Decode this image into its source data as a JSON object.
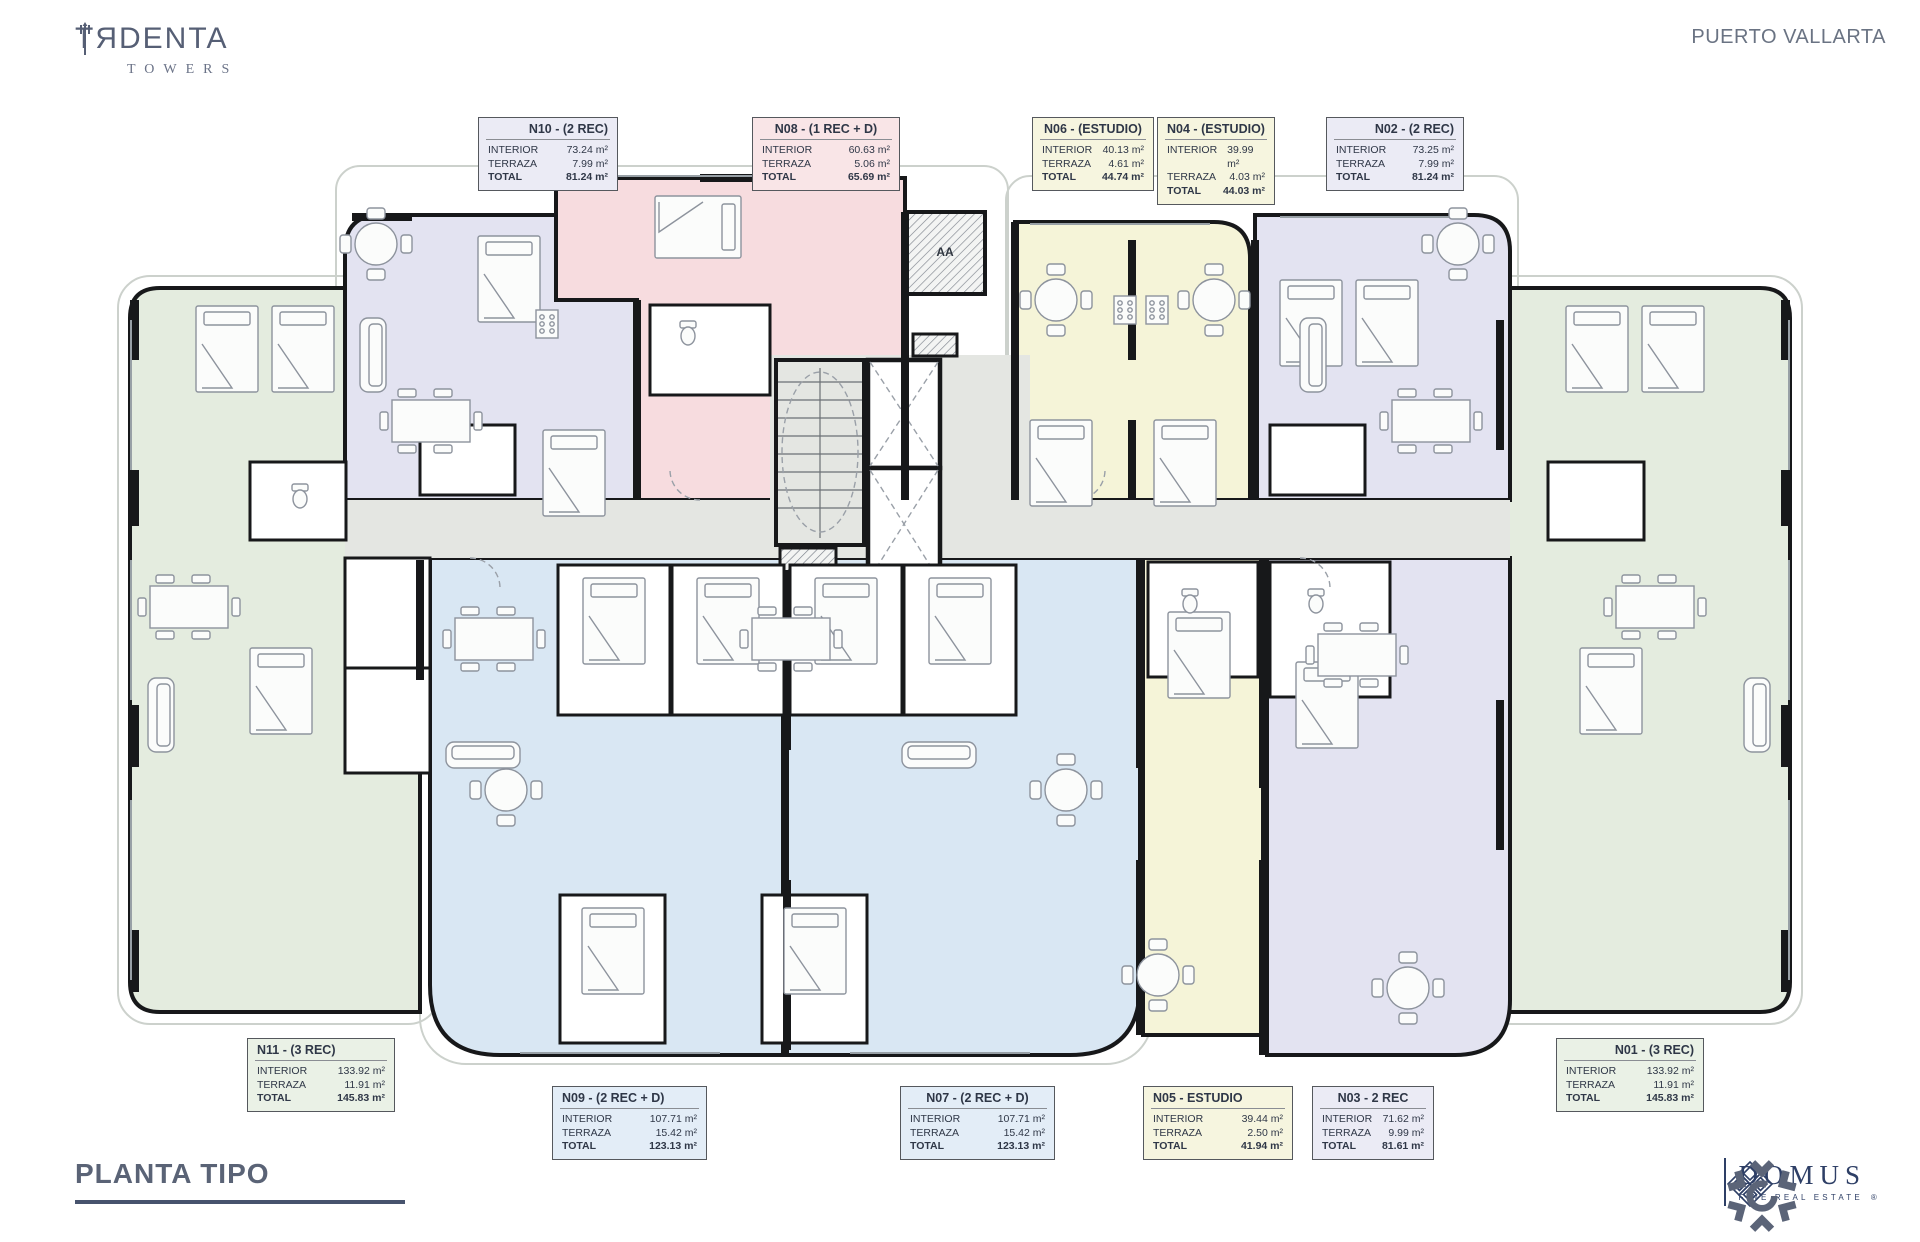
{
  "header": {
    "brand_part1": "TЯ",
    "brand_part2": "DENTA",
    "brand_sub": "TOWERS",
    "location": "PUERTO VALLARTA"
  },
  "labels": {
    "interior": "INTERIOR",
    "terraza": "TERRAZA",
    "total": "TOTAL"
  },
  "units": [
    {
      "id": "N10",
      "title": "N10 - (2 REC)",
      "interior": "73.24 m²",
      "terraza": "7.99 m²",
      "total": "81.24 m²",
      "tint": "#ebebf5"
    },
    {
      "id": "N08",
      "title": "N08 - (1 REC + D)",
      "interior": "60.63 m²",
      "terraza": "5.06 m²",
      "total": "65.69 m²",
      "tint": "#f9e5e7"
    },
    {
      "id": "N06",
      "title": "N06 - (ESTUDIO)",
      "interior": "40.13 m²",
      "terraza": "4.61 m²",
      "total": "44.74 m²",
      "tint": "#f6f5df"
    },
    {
      "id": "N04",
      "title": "N04 - (ESTUDIO)",
      "interior": "39.99 m²",
      "terraza": "4.03 m²",
      "total": "44.03 m²",
      "tint": "#f6f5df"
    },
    {
      "id": "N02",
      "title": "N02 - (2 REC)",
      "interior": "73.25 m²",
      "terraza": "7.99 m²",
      "total": "81.24 m²",
      "tint": "#ebebf5"
    },
    {
      "id": "N11",
      "title": "N11 - (3 REC)",
      "interior": "133.92 m²",
      "terraza": "11.91 m²",
      "total": "145.83 m²",
      "tint": "#eaf1e6"
    },
    {
      "id": "N09",
      "title": "N09 - (2 REC + D)",
      "interior": "107.71 m²",
      "terraza": "15.42 m²",
      "total": "123.13 m²",
      "tint": "#e3edf7"
    },
    {
      "id": "N07",
      "title": "N07 - (2 REC + D)",
      "interior": "107.71 m²",
      "terraza": "15.42 m²",
      "total": "123.13 m²",
      "tint": "#e3edf7"
    },
    {
      "id": "N05",
      "title": "N05 - ESTUDIO",
      "interior": "39.44 m²",
      "terraza": "2.50 m²",
      "total": "41.94 m²",
      "tint": "#f6f5df"
    },
    {
      "id": "N03",
      "title": "N03 - 2 REC",
      "interior": "71.62 m²",
      "terraza": "9.99 m²",
      "total": "81.61 m²",
      "tint": "#ebebf5"
    },
    {
      "id": "N01",
      "title": "N01 - (3 REC)",
      "interior": "133.92 m²",
      "terraza": "11.91 m²",
      "total": "145.83 m²",
      "tint": "#eaf1e6"
    }
  ],
  "plan": {
    "core_label": "AA"
  },
  "footer": {
    "plan_title": "PLANTA TIPO",
    "domus_name": "DOMUS",
    "domus_tagline": "FINE REAL ESTATE",
    "domus_reg": "®"
  },
  "colors": {
    "green": "#e4ecdf",
    "lavender": "#e3e3f1",
    "pink": "#f7dcdf",
    "yellow": "#f5f4d8",
    "blue": "#d9e7f3",
    "corridor": "#e4e6e2",
    "wall": "#17181a",
    "accent_navy": "#2e3f66",
    "title_gray": "#5a6376"
  }
}
